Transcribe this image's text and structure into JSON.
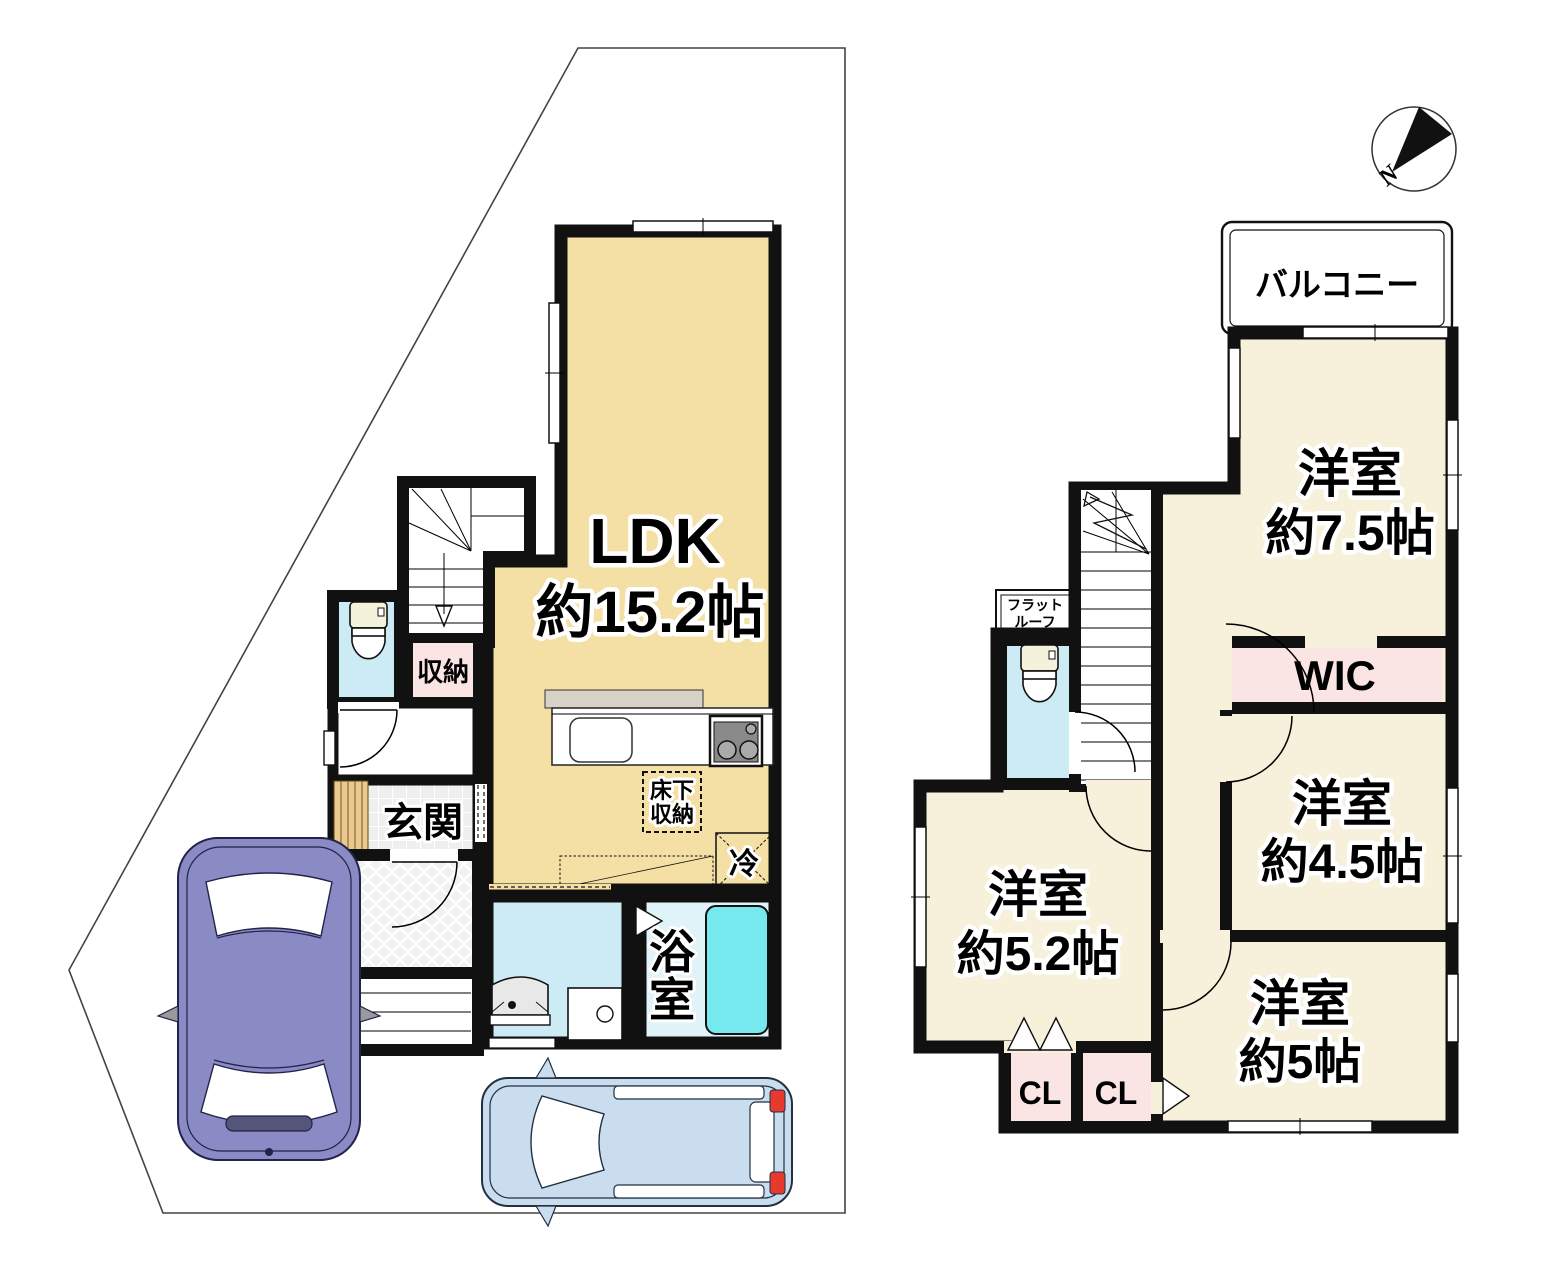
{
  "compass": {
    "north_label": "N"
  },
  "floor1": {
    "ldk_name": "LDK",
    "ldk_size": "約15.2帖",
    "storage_label": "収納",
    "entrance_label": "玄関",
    "underfloor_line1": "床下",
    "underfloor_line2": "収納",
    "fridge_label": "冷",
    "bath_char1": "浴",
    "bath_char2": "室"
  },
  "floor2": {
    "balcony_label": "バルコニー",
    "flatroof_line1": "フラット",
    "flatroof_line2": "ルーフ",
    "room75_name": "洋室",
    "room75_size": "約7.5帖",
    "wic_label": "WIC",
    "room45_name": "洋室",
    "room45_size": "約4.5帖",
    "room5_name": "洋室",
    "room5_size": "約5帖",
    "room52_name": "洋室",
    "room52_size": "約5.2帖",
    "closet1_label": "CL",
    "closet2_label": "CL"
  },
  "colors": {
    "wall": "#111111",
    "ldk_fill": "#F4DFA4",
    "room_fill": "#F7F0DB",
    "closet_pink": "#FBE4E4",
    "water_blue": "#CDEBF4",
    "bath_floor": "#E0F3F8",
    "tub_cyan": "#76E9EF",
    "counter_gray": "#D8D1C5",
    "wood_tan": "#E9C98E",
    "car_purple": "#8A8AC4",
    "car_blue": "#C9DDEF",
    "taillight_red": "#E63A2E"
  }
}
